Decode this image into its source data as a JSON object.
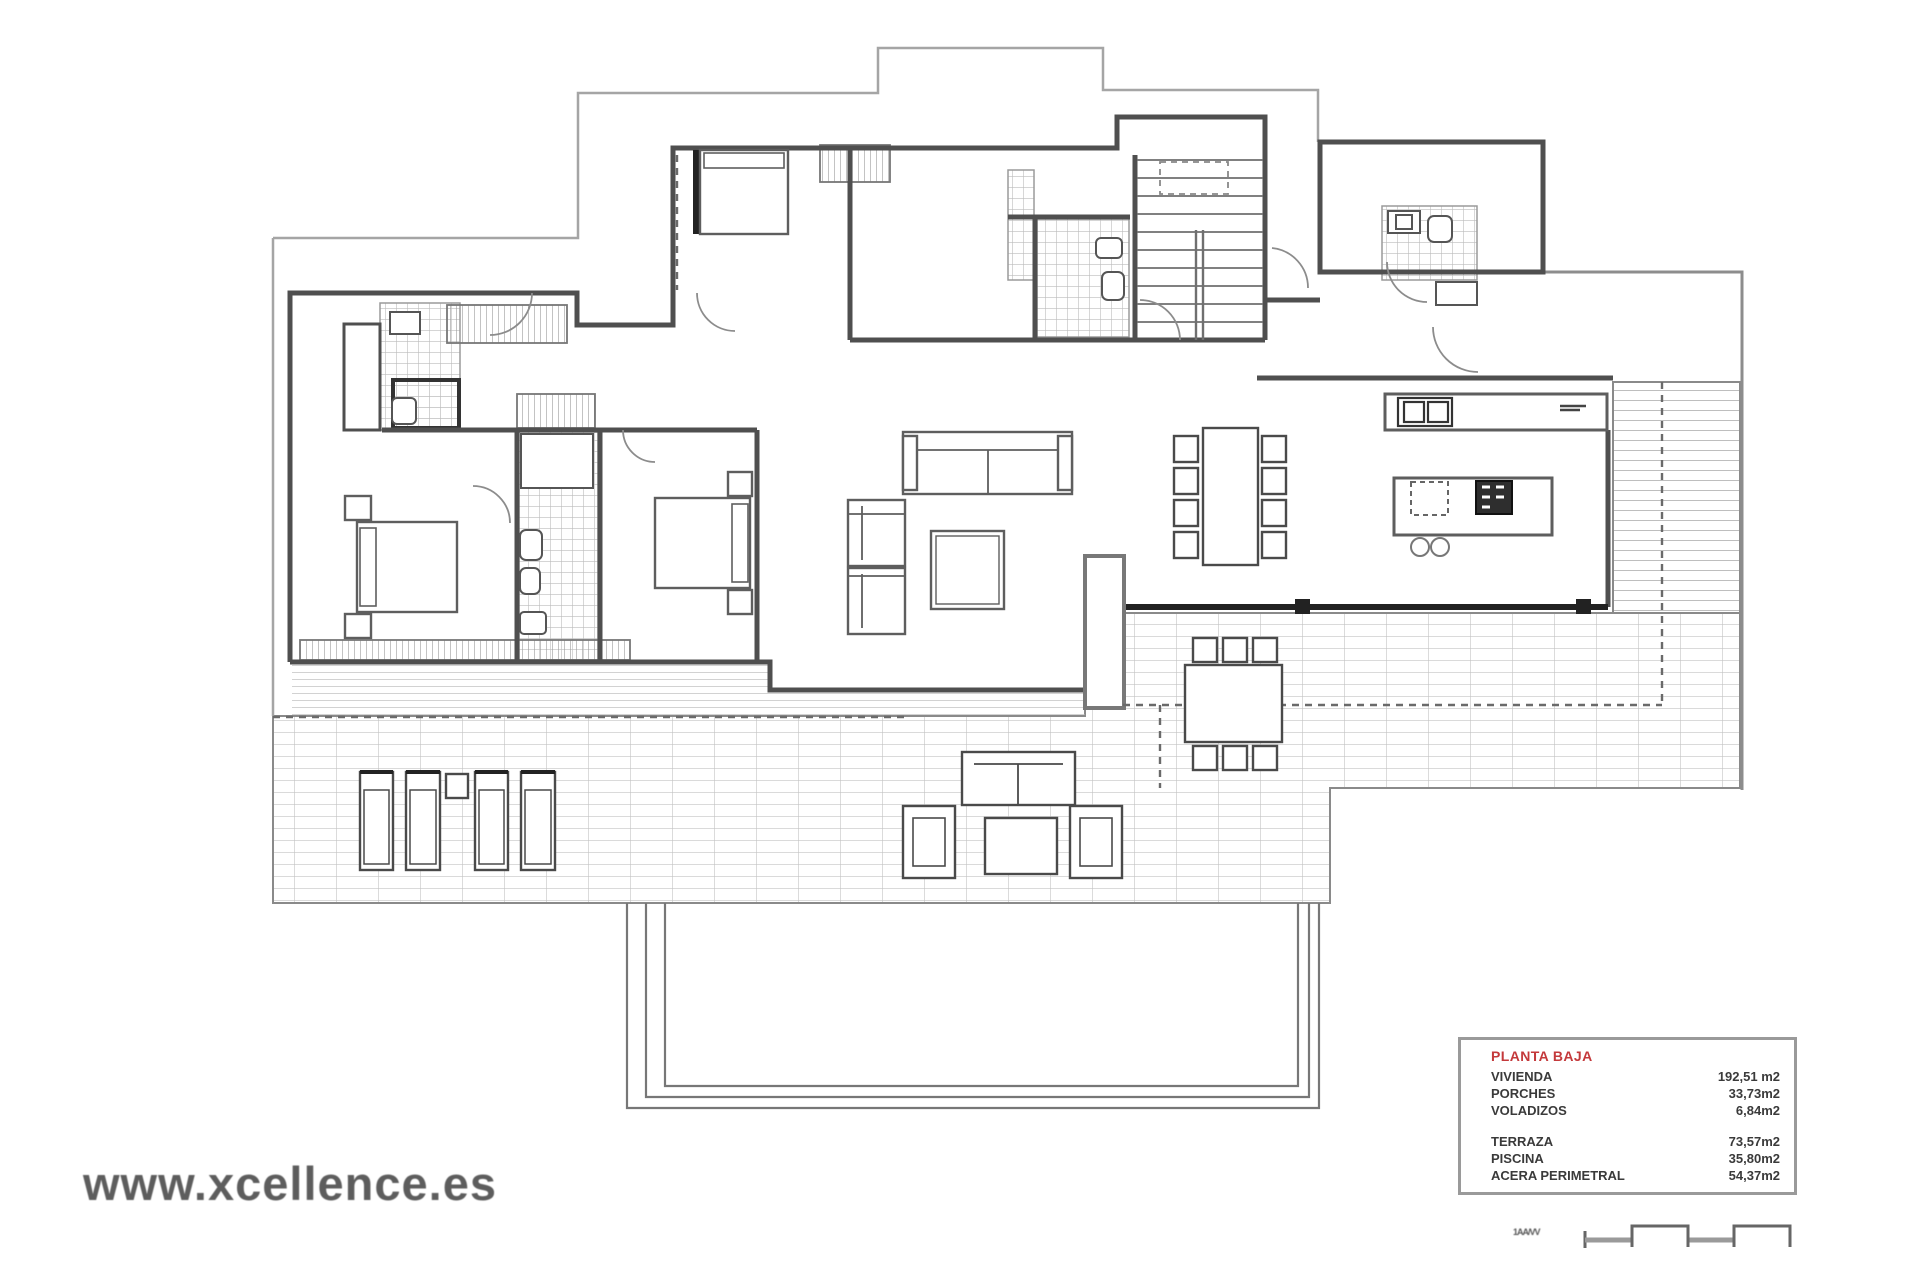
{
  "watermark": {
    "text": "www.xcellence.es"
  },
  "legend": {
    "title": "PLANTA BAJA",
    "rows": [
      {
        "label": "VIVIENDA",
        "value": "192,51 m2"
      },
      {
        "label": "PORCHES",
        "value": "33,73m2"
      },
      {
        "label": "VOLADIZOS",
        "value": "6,84m2"
      },
      {
        "label": "TERRAZA",
        "value": "73,57m2"
      },
      {
        "label": "PISCINA",
        "value": "35,80m2"
      },
      {
        "label": "ACERA PERIMETRAL",
        "value": "54,37m2"
      }
    ]
  },
  "scale_bar": {
    "label": "1AA/VV"
  },
  "colors": {
    "wall": "#4f4f4f",
    "dark_wall": "#222222",
    "tile_line": "#b8b8b8",
    "terrace_line": "#c2c2c2",
    "legend_title": "#c4393b",
    "watermark": "#5d5d5d"
  }
}
